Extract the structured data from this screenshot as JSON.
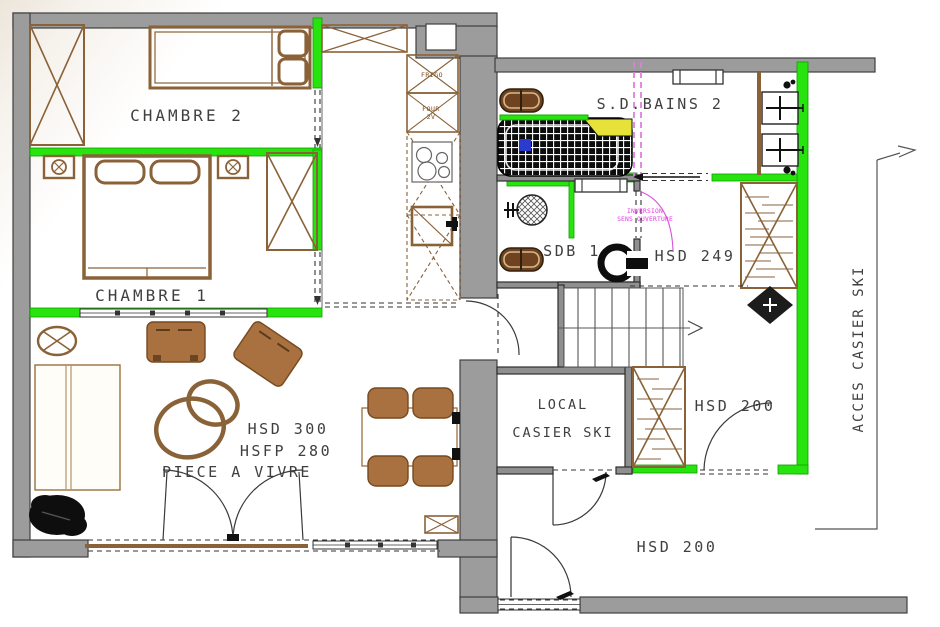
{
  "colors": {
    "wall_gray": "#9c9c9c",
    "inner_wall_gray": "#8f8f8f",
    "new_wall_green": "#27e30e",
    "wood_brown": "#8a6238",
    "furniture_brown": "#a8713f",
    "note_magenta": "#e23ae2",
    "bathtub_yellow": "#e6e23a",
    "bathtub_blue": "#2a3bd0",
    "fixture_black": "#111111",
    "text_gray": "#3f3f3f"
  },
  "rooms": {
    "chambre2": {
      "label": "CHAMBRE 2"
    },
    "chambre1": {
      "label": "CHAMBRE 1"
    },
    "piece_a_vivre": {
      "label": "PIECE A VIVRE",
      "hsd": "HSD 300",
      "hsfp": "HSFP 280"
    },
    "sdb2": {
      "label": "S.D.BAINS 2"
    },
    "sdb1": {
      "label": "SDB 1"
    },
    "hsd249": {
      "label": "HSD 249"
    },
    "hsd200_mid": {
      "label": "HSD 200"
    },
    "hsd200_bottom": {
      "label": "HSD 200"
    },
    "local_casier_ski": {
      "line1": "LOCAL",
      "line2": "CASIER SKI"
    }
  },
  "kitchen": {
    "frigo": "FRIGO",
    "four": "FOUR",
    "four_sub": "2V"
  },
  "notes": {
    "acces": "ACCES CASIER SKI",
    "inversion_line1": "INVERSION",
    "inversion_line2": "SENS OUVERTURE"
  }
}
